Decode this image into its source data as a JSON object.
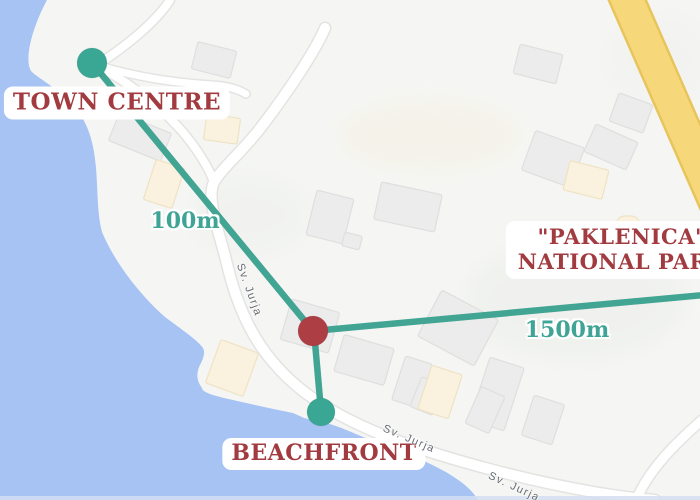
{
  "labels": {
    "town_centre": "TOWN CENTRE",
    "beachfront": "BEACHFRONT",
    "park_line1": "\"PAKLENICA\"",
    "park_line2": "NATIONAL PARK",
    "distance_town": "100m",
    "distance_park": "1500m"
  },
  "streets": [
    {
      "text": "Sv. Jurja",
      "x": 249,
      "y": 290,
      "angle": 70
    },
    {
      "text": "Sv. Jurja",
      "x": 409,
      "y": 439,
      "angle": 23
    },
    {
      "text": "Sv. Jurja",
      "x": 514,
      "y": 487,
      "angle": 25
    }
  ],
  "colors": {
    "water": "#a6c3f4",
    "land": "#f5f6f3",
    "teal_route": "#42a493",
    "teal_text": "#3fa495",
    "marker_teal": "#3aa794",
    "marker_red": "#ad3f44",
    "label_red": "#a23b40",
    "road_fill": "#ffffff",
    "road_casing": "#e3e4e2",
    "highway_fill": "#f6d87b",
    "highway_edge": "#e8c45c",
    "building_gray": "#ebeceb",
    "building_gray_edge": "#dedfde",
    "building_cream": "#faf2df",
    "building_cream_edge": "#efe2c3",
    "street_text": "#666b72",
    "bottom_strip": "#d2def2"
  },
  "geometry": {
    "water_d": "M47,0 L0,0 L0,500 L478,500 C469,484 444,468 404,453 C376,443 350,431 336,426 C325,422 312,420 304,418 C298,415 295,414 293,413 C278,410 250,404 224,398 C212,395 202,392 202,388 C196,380 196,372 201,363 C204,357 205,352 203,348 C198,341 188,334 165,317 C140,295 115,263 102,232 C97,212 98,192 96,168 C94,146 90,128 78,111 C62,90 40,80 31,71 C24,59 32,28 47,0 Z",
    "bottom_strip": {
      "y": 496,
      "h": 4
    },
    "patches": [
      {
        "x": 430,
        "y": 135,
        "rx": 90,
        "ry": 35,
        "fill": "#f4f0e2",
        "o": 0.55
      },
      {
        "x": 575,
        "y": 300,
        "rx": 110,
        "ry": 60,
        "fill": "#eef0ec",
        "o": 0.7
      },
      {
        "x": 250,
        "y": 215,
        "rx": 60,
        "ry": 40,
        "fill": "#eff1ee",
        "o": 0.6
      },
      {
        "x": 660,
        "y": 60,
        "rx": 55,
        "ry": 45,
        "fill": "#f2f3f0",
        "o": 0.7
      }
    ],
    "roads": [
      {
        "d": "M325,28 C316,50 288,92 262,126 C244,150 222,168 214,182 C206,198 219,232 226,260 C236,304 252,338 273,362 C301,396 343,420 393,439 C452,461 526,480 593,492 C618,496 640,499 655,500",
        "w": 10
      },
      {
        "d": "M96,65 C126,81 158,104 181,130 C193,144 205,161 213,179",
        "w": 8
      },
      {
        "d": "M170,0 C156,22 126,46 100,63",
        "w": 8
      },
      {
        "d": "M100,66 C140,78 178,83 212,85 C228,86 238,89 246,94",
        "w": 7
      },
      {
        "d": "M702,420 C676,443 650,468 636,500",
        "w": 9
      }
    ],
    "highway_points": "607,-4 644,-4 707,140 707,224",
    "buildings": [
      {
        "x": 214,
        "y": 60,
        "w": 40,
        "h": 28,
        "r": 14,
        "t": "g"
      },
      {
        "x": 140,
        "y": 137,
        "w": 56,
        "h": 30,
        "r": 22,
        "t": "g"
      },
      {
        "x": 222,
        "y": 129,
        "w": 34,
        "h": 26,
        "r": 8,
        "t": "c"
      },
      {
        "x": 164,
        "y": 184,
        "w": 30,
        "h": 42,
        "r": 18,
        "t": "c"
      },
      {
        "x": 330,
        "y": 217,
        "w": 38,
        "h": 46,
        "r": 14,
        "t": "g"
      },
      {
        "x": 352,
        "y": 241,
        "w": 18,
        "h": 14,
        "r": 14,
        "t": "g"
      },
      {
        "x": 408,
        "y": 207,
        "w": 62,
        "h": 38,
        "r": 12,
        "t": "g"
      },
      {
        "x": 538,
        "y": 64,
        "w": 44,
        "h": 30,
        "r": 14,
        "t": "g"
      },
      {
        "x": 553,
        "y": 159,
        "w": 52,
        "h": 42,
        "r": 20,
        "t": "g"
      },
      {
        "x": 611,
        "y": 147,
        "w": 46,
        "h": 30,
        "r": 24,
        "t": "g"
      },
      {
        "x": 631,
        "y": 113,
        "w": 36,
        "h": 30,
        "r": 20,
        "t": "g"
      },
      {
        "x": 586,
        "y": 180,
        "w": 40,
        "h": 30,
        "r": 14,
        "t": "c"
      },
      {
        "x": 628,
        "y": 226,
        "w": 24,
        "h": 20,
        "r": 0,
        "t": "c",
        "rx": 9
      },
      {
        "x": 310,
        "y": 326,
        "w": 50,
        "h": 42,
        "r": 16,
        "t": "g"
      },
      {
        "x": 364,
        "y": 360,
        "w": 52,
        "h": 38,
        "r": 16,
        "t": "g"
      },
      {
        "x": 412,
        "y": 382,
        "w": 28,
        "h": 46,
        "r": 18,
        "t": "g"
      },
      {
        "x": 427,
        "y": 396,
        "w": 24,
        "h": 32,
        "r": 22,
        "t": "g"
      },
      {
        "x": 440,
        "y": 392,
        "w": 32,
        "h": 46,
        "r": 18,
        "t": "c"
      },
      {
        "x": 458,
        "y": 328,
        "w": 64,
        "h": 52,
        "r": 28,
        "t": "g"
      },
      {
        "x": 497,
        "y": 394,
        "w": 36,
        "h": 66,
        "r": 18,
        "t": "g"
      },
      {
        "x": 485,
        "y": 410,
        "w": 26,
        "h": 40,
        "r": 24,
        "t": "g"
      },
      {
        "x": 543,
        "y": 420,
        "w": 32,
        "h": 42,
        "r": 18,
        "t": "g"
      },
      {
        "x": 232,
        "y": 368,
        "w": 40,
        "h": 46,
        "r": 20,
        "t": "c"
      }
    ],
    "routes": [
      {
        "x1": 93,
        "y1": 64,
        "x2": 313,
        "y2": 331,
        "name": "route-town-centre"
      },
      {
        "x1": 313,
        "y1": 331,
        "x2": 704,
        "y2": 295,
        "name": "route-national-park"
      },
      {
        "x1": 314,
        "y1": 331,
        "x2": 321,
        "y2": 411,
        "name": "route-beachfront"
      }
    ],
    "markers": [
      {
        "x": 92,
        "y": 63,
        "r": 15,
        "c": "teal",
        "name": "town-centre-marker"
      },
      {
        "x": 313,
        "y": 331,
        "r": 15,
        "c": "red",
        "name": "property-marker"
      },
      {
        "x": 321,
        "y": 412,
        "r": 14,
        "c": "teal",
        "name": "beachfront-marker"
      }
    ]
  }
}
